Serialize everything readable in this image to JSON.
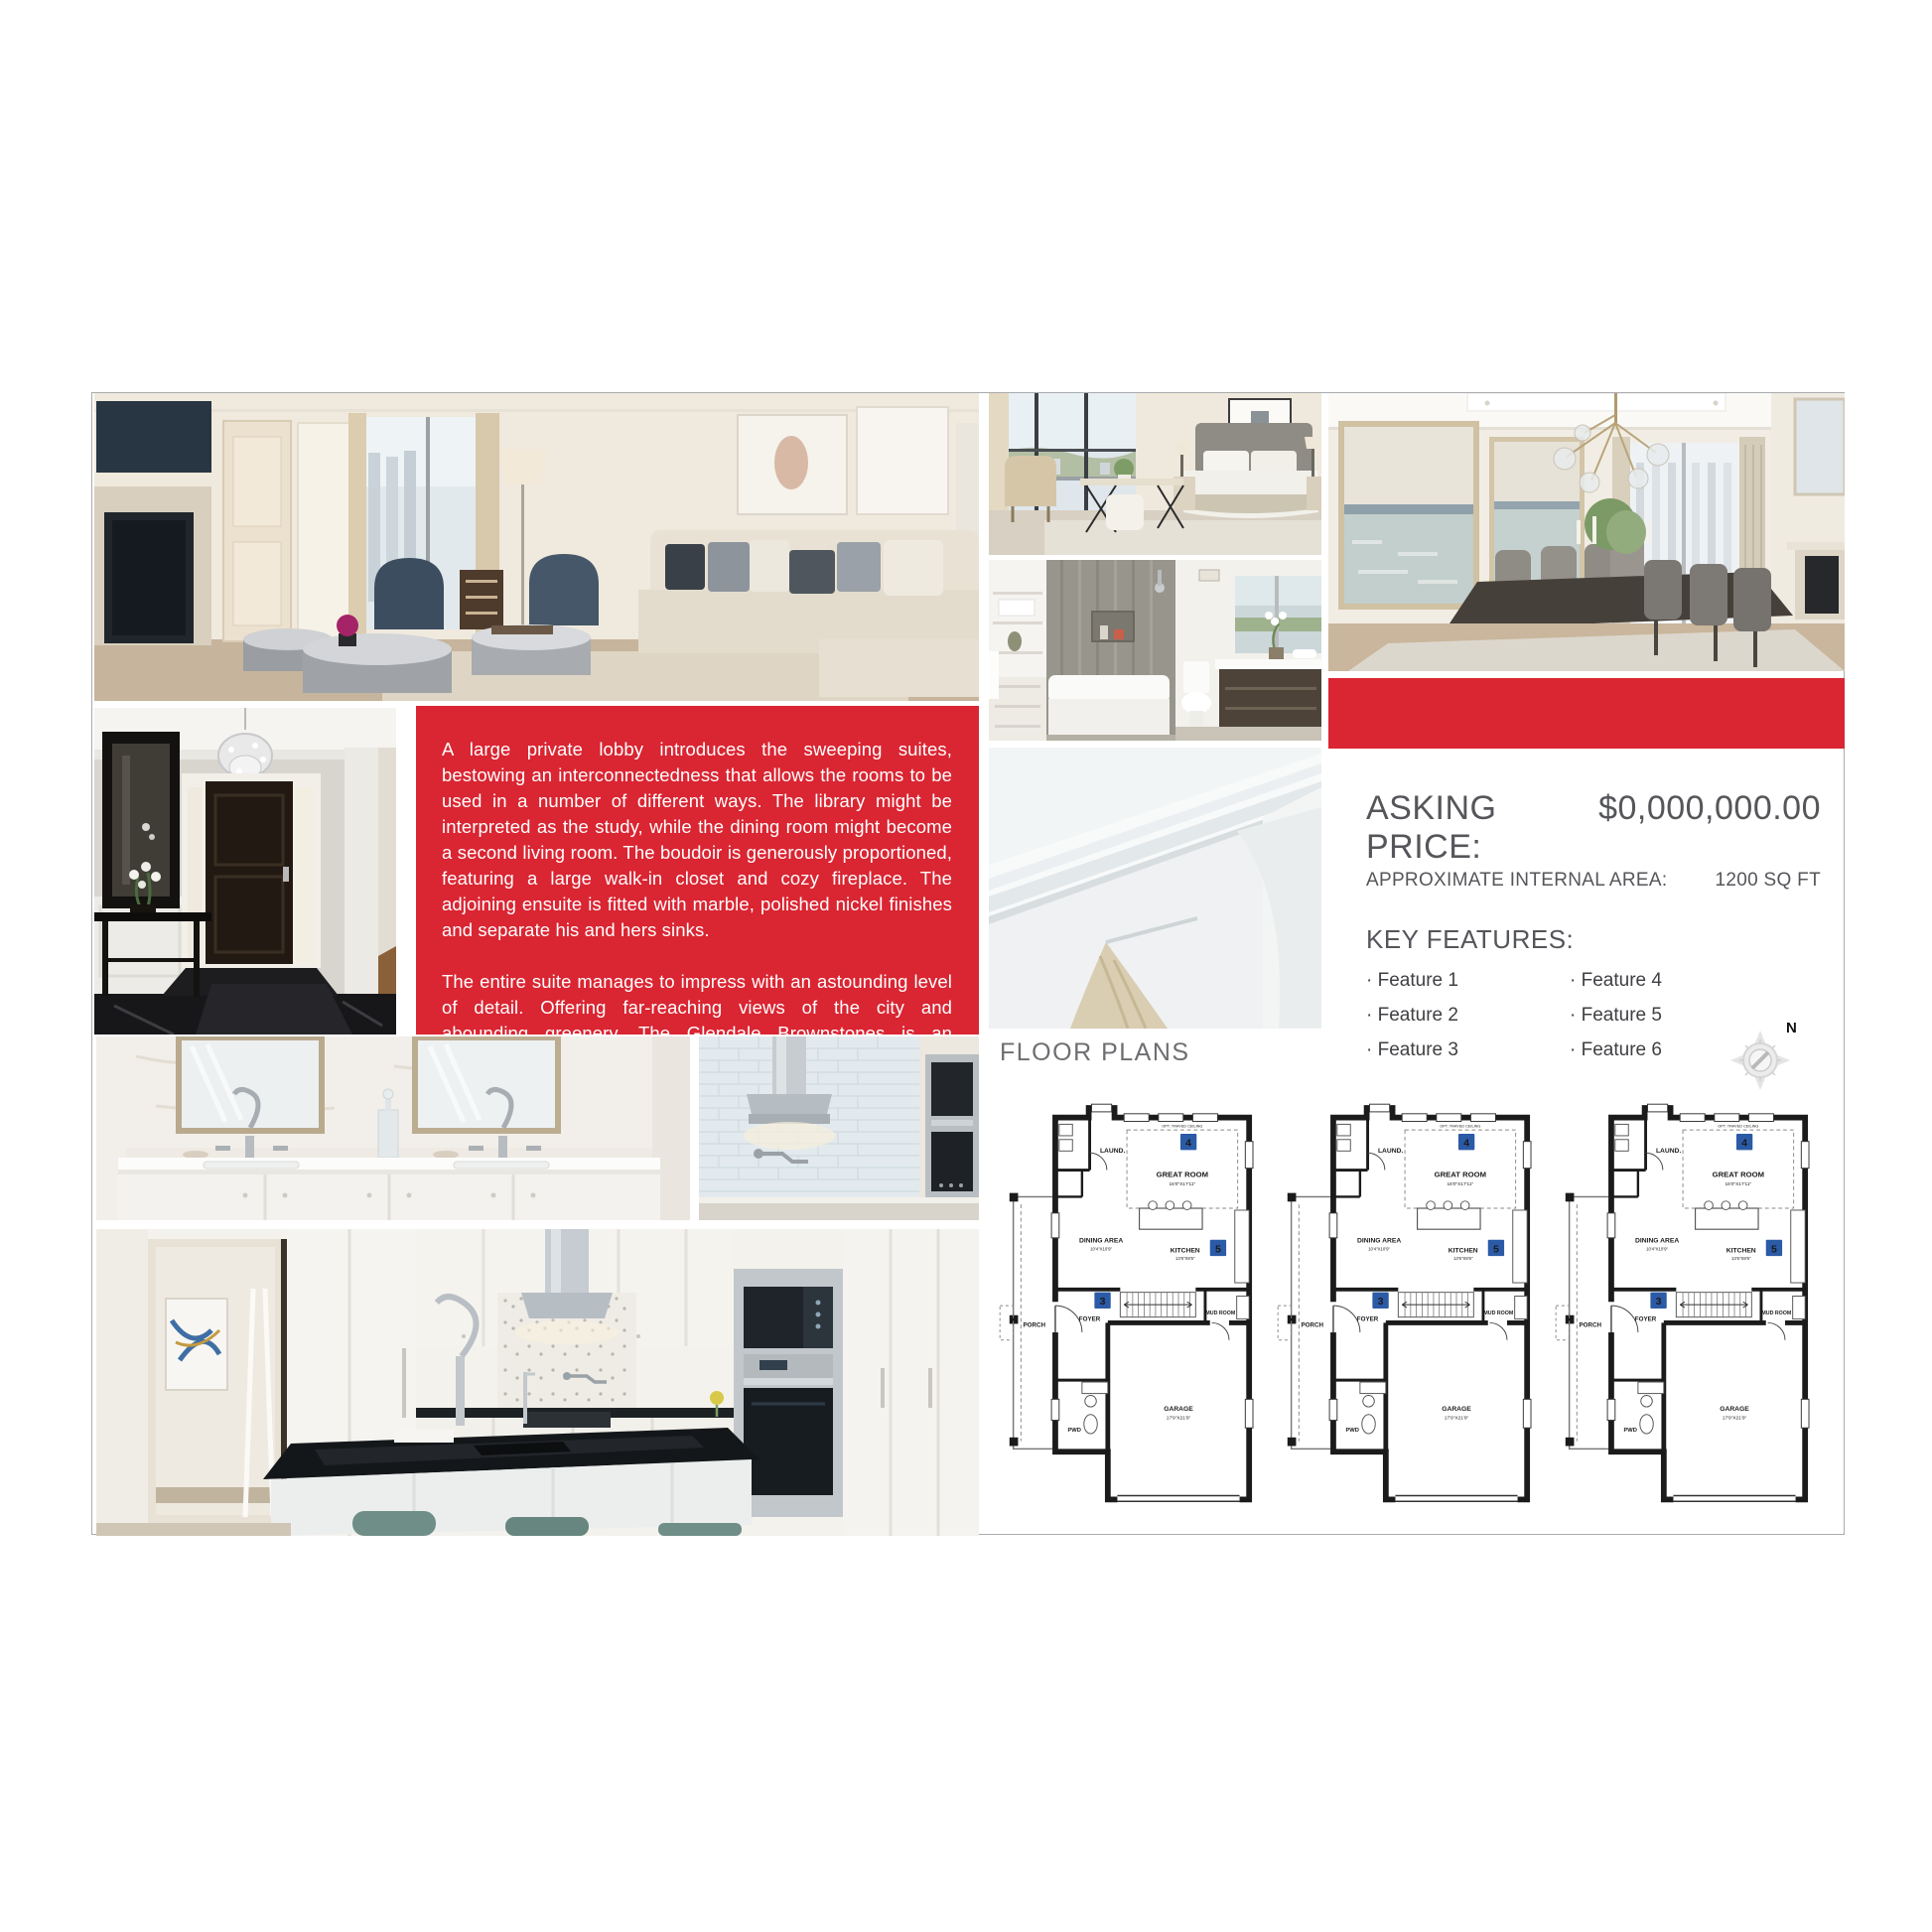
{
  "description": {
    "p1": "A large private lobby introduces the sweeping suites, bestowing an interconnectedness that allows the rooms to be used in a number of different ways. The library might be interpreted as the study, while the dining room might become a second living room. The boudoir is generously proportioned, featuring a large walk-in closet and cozy fireplace. The adjoining ensuite is fitted with marble, polished nickel finishes and separate his and hers sinks.",
    "p2": "The entire suite manages to impress with an astounding level of detail. Offering far-reaching views of the city and abounding greenery, The Glendale Brownstones is an inspiring place."
  },
  "pricing": {
    "asking_label": "ASKING PRICE:",
    "asking_value": "$0,000,000.00",
    "area_label": "APPROXIMATE INTERNAL AREA:",
    "area_value": "1200 SQ FT",
    "features_label": "KEY FEATURES:",
    "features": [
      "· Feature 1",
      "· Feature 2",
      "· Feature 3",
      "· Feature 4",
      "· Feature 5",
      "· Feature 6"
    ]
  },
  "floor_plans": {
    "heading": "FLOOR PLANS",
    "compass": "N",
    "plan": {
      "laundry": "LAUND.",
      "ceiling_note": "OPT. TRAYED CEILING",
      "great_room": "GREAT ROOM",
      "great_room_dim": "16'0\"X17'11\"",
      "dining": "DINING AREA",
      "dining_dim": "10'4\"X10'9\"",
      "kitchen": "KITCHEN",
      "kitchen_dim": "13'6\"X8'6\"",
      "foyer": "FOYER",
      "mud_room": "MUD ROOM",
      "porch": "PORCH",
      "pwd": "PWD",
      "garage": "GARAGE",
      "garage_dim": "17'9\"X21'9\"",
      "badge_great": "4",
      "badge_kitchen": "5",
      "badge_foyer": "3"
    },
    "colors": {
      "badge_blue": "#2b5aa6"
    }
  },
  "theme": {
    "accent_red": "#da2532",
    "heading_gray": "#6d6e71",
    "text_gray": "#55565a"
  }
}
